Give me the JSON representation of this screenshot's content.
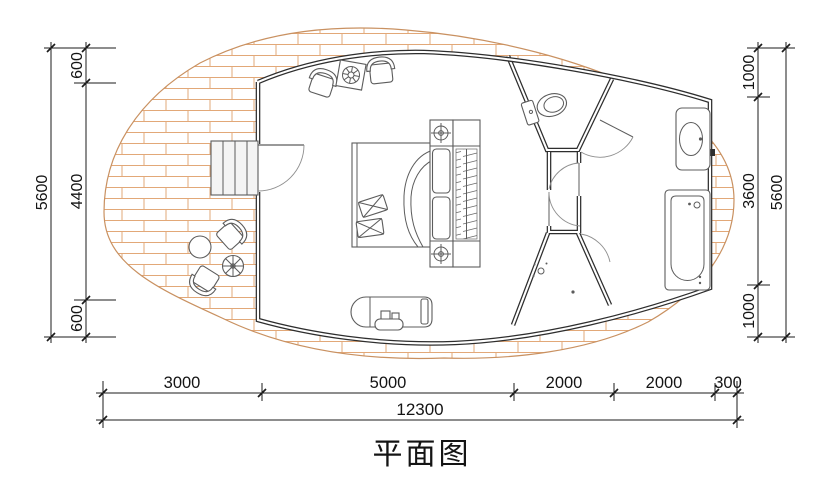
{
  "title": {
    "text": "平面图"
  },
  "dimensions": {
    "left": {
      "total": "5600",
      "chain": [
        "600",
        "4400",
        "600"
      ]
    },
    "right": {
      "total": "5600",
      "chain": [
        "1000",
        "3600",
        "1000"
      ]
    },
    "bottom": {
      "total": "12300",
      "chain": [
        "3000",
        "5000",
        "2000",
        "2000",
        "300"
      ]
    }
  },
  "colors": {
    "wall": "#2e2e2e",
    "brick_line": "#e2a878",
    "deck_outline": "#c99161",
    "furniture_line": "#5c5c5c",
    "dimension_line": "#1b1b1b"
  },
  "furniture": [
    "entry-steps",
    "entry-door",
    "lounge-chair-left",
    "decor-table",
    "lounge-chair-right",
    "double-bed",
    "pillows",
    "nightstand-lamp-top",
    "nightstand-lamp-bottom",
    "wardrobe-hangers",
    "tv-console",
    "deck-chair-upper",
    "deck-chair-lower",
    "deck-round-table",
    "deck-parasol-table",
    "toilet",
    "shower-drain",
    "washbasin",
    "bathtub"
  ]
}
